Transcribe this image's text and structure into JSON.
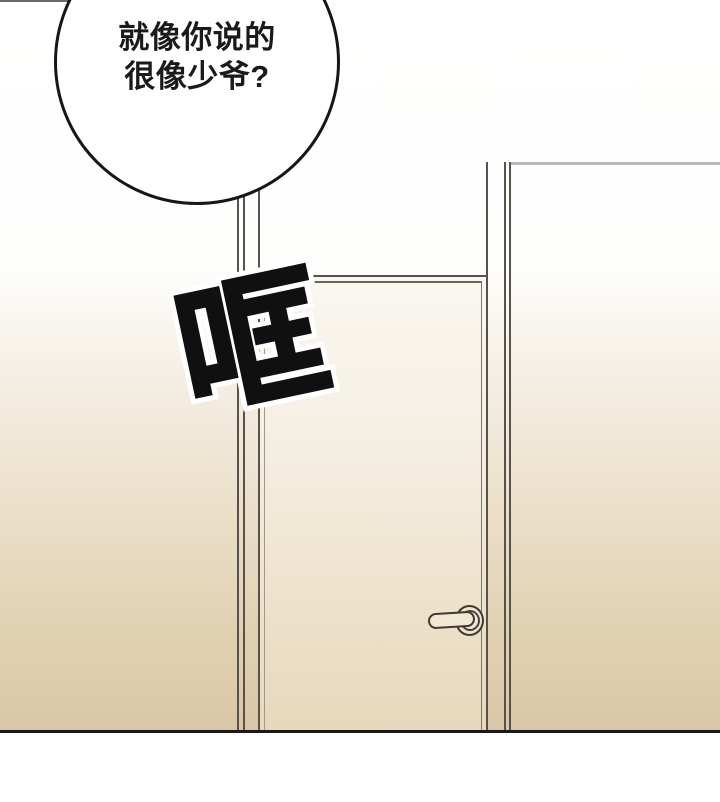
{
  "comic": {
    "speech_bubble": {
      "lines": [
        "就像你说的",
        "很像少爷?"
      ]
    },
    "sfx": {
      "text": "哐"
    },
    "colors": {
      "ink": "#161616",
      "wall_top": "#ffffff",
      "wall_bottom": "#d9c6a6",
      "door_top": "#faf7f1",
      "door_bottom": "#e7d8bc",
      "frame_line": "#57524a",
      "floor_line": "#191919",
      "sfx_fill": "#101010",
      "sfx_outline": "#ffffff"
    }
  }
}
